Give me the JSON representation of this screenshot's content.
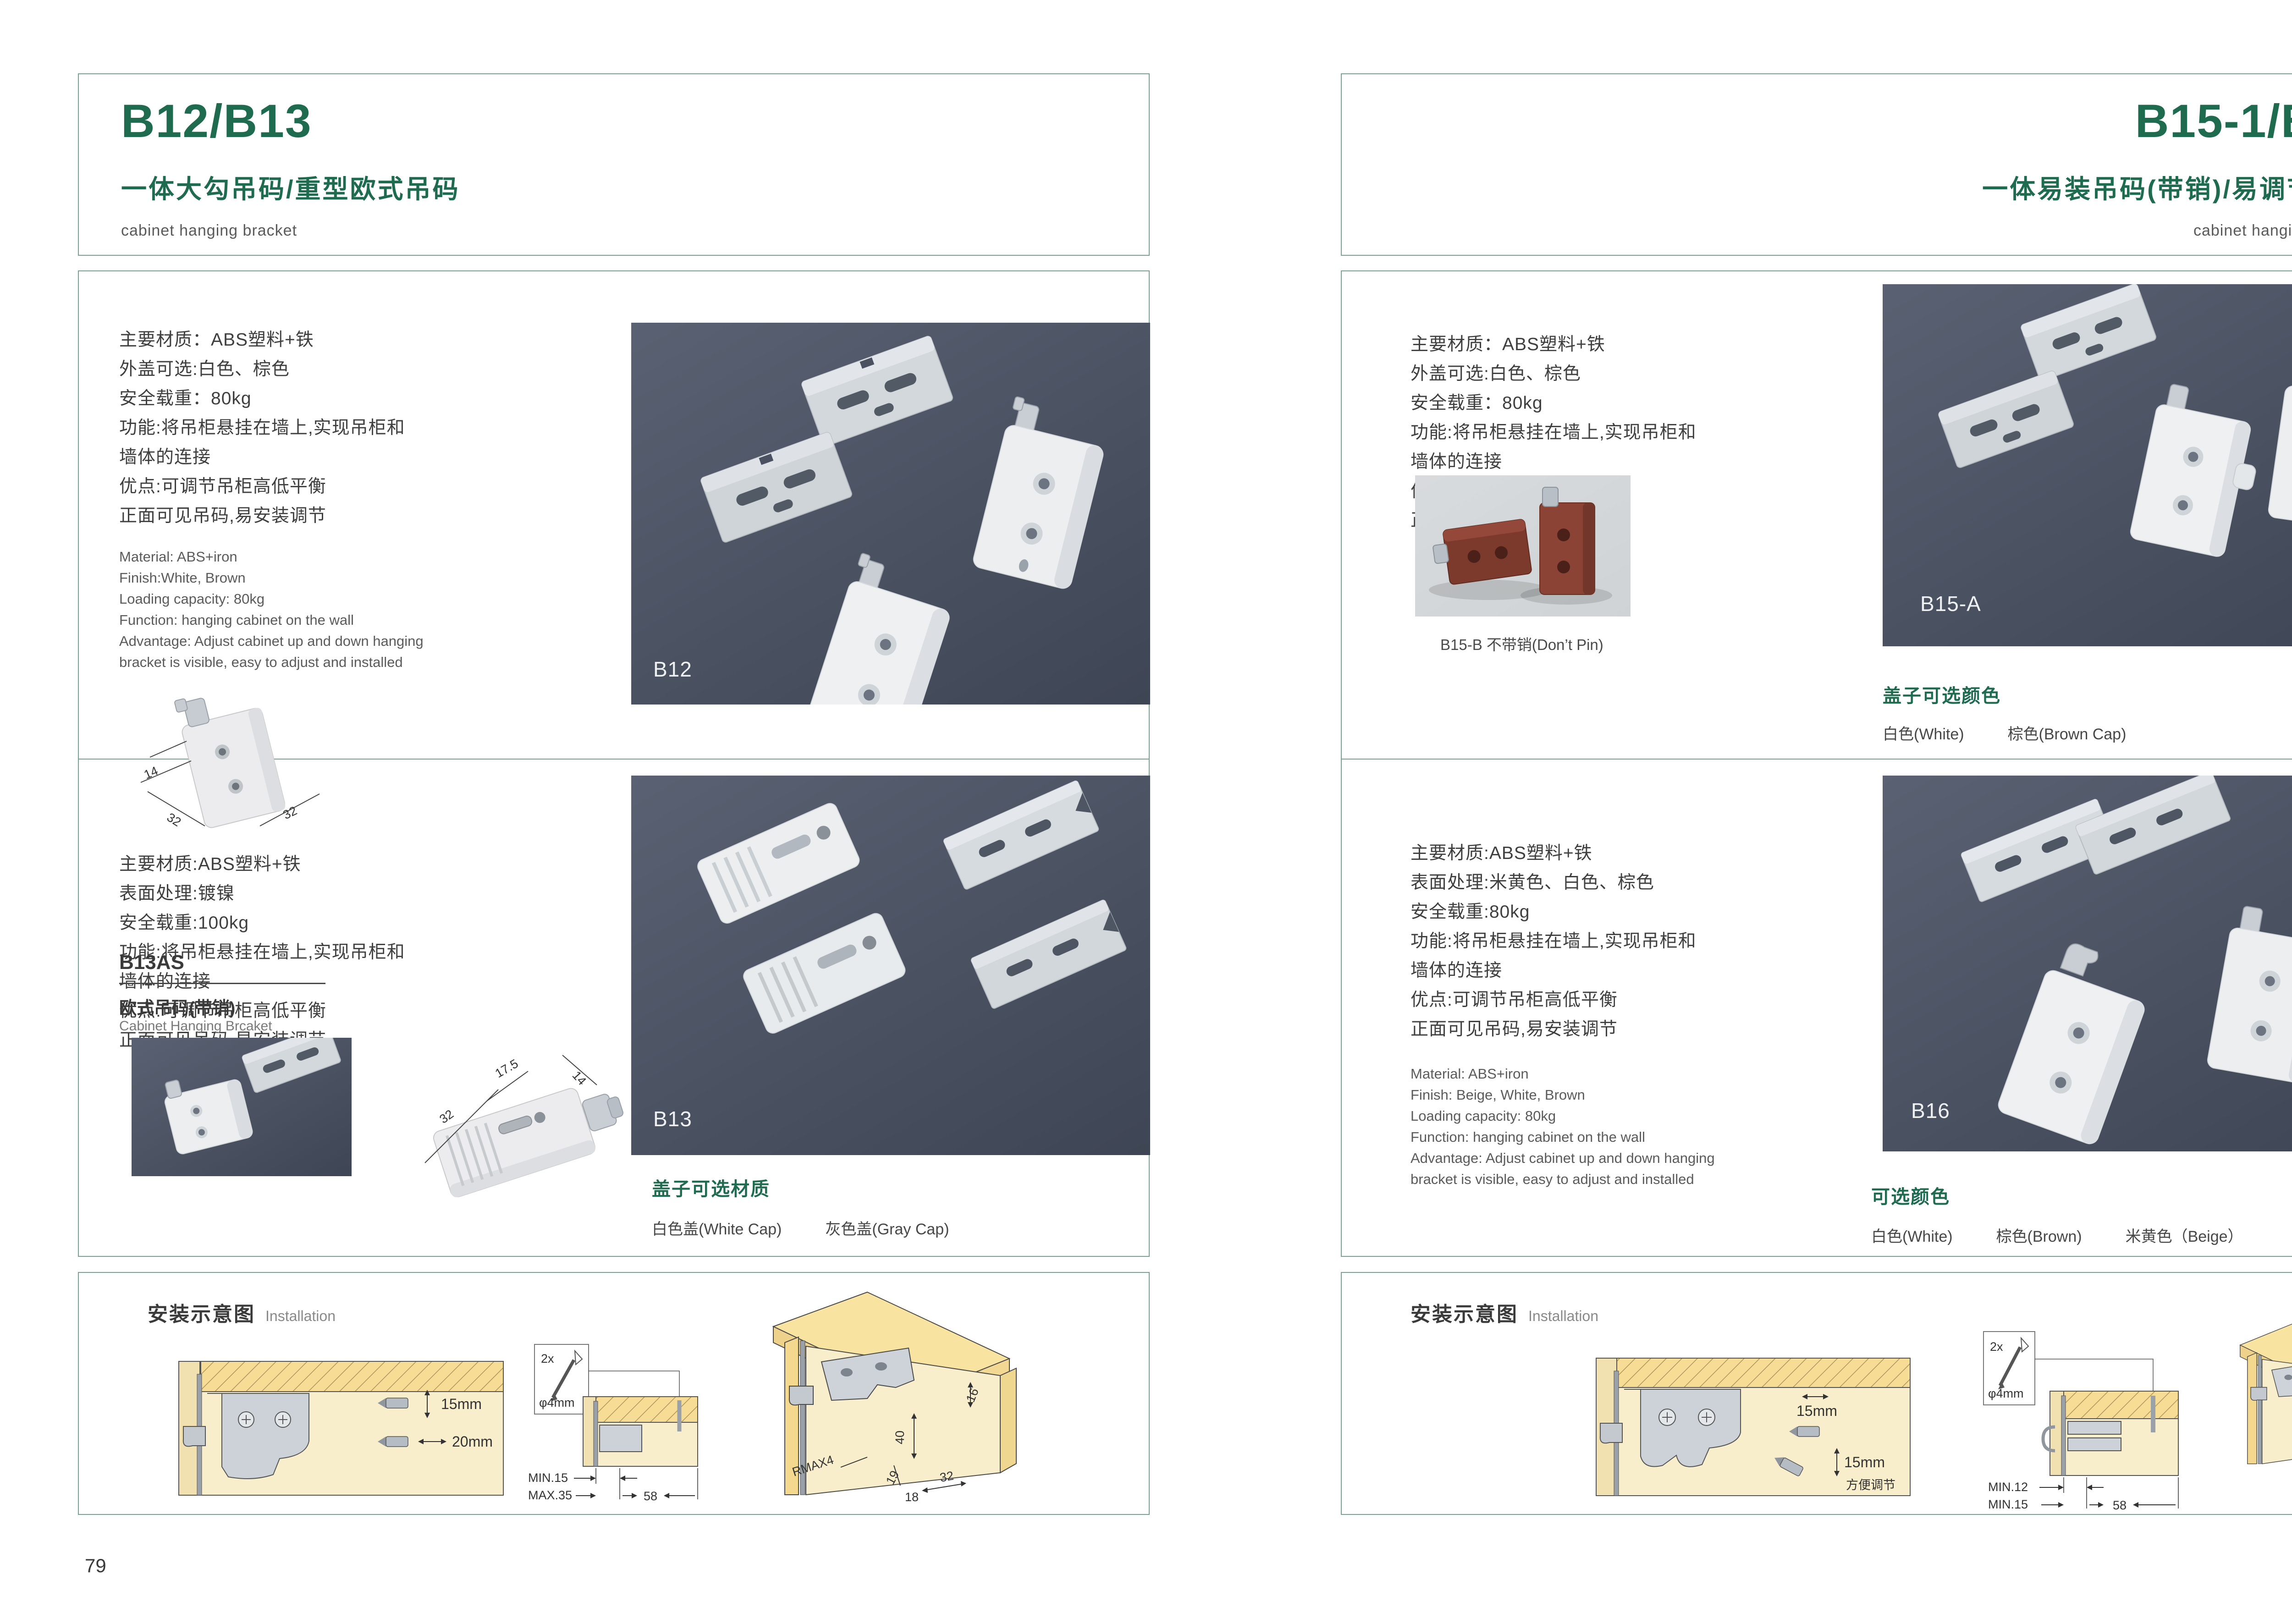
{
  "left": {
    "header": {
      "title": "B12/B13",
      "subtitle": "一体大勾吊码/重型欧式吊码",
      "category": "cabinet hanging bracket"
    },
    "b12": {
      "cn": [
        "主要材质：ABS塑料+铁",
        "外盖可选:白色、棕色",
        "安全载重：80kg",
        "功能:将吊柜悬挂在墙上,实现吊柜和",
        "墙体的连接",
        "优点:可调节吊柜高低平衡",
        "正面可见吊码,易安装调节"
      ],
      "en": [
        "Material: ABS+iron",
        "Finish:White, Brown",
        "Loading capacity: 80kg",
        "Function: hanging cabinet on the wall",
        "Advantage: Adjust cabinet up and down hanging",
        "bracket is visible, easy to adjust and installed"
      ],
      "photo_label": "B12",
      "sketch": {
        "d1": "14",
        "d2": "32",
        "d3": "32"
      }
    },
    "b13": {
      "cn": [
        "主要材质:ABS塑料+铁",
        "表面处理:镀镍",
        "安全载重:100kg",
        "功能:将吊柜悬挂在墙上,实现吊柜和",
        "墙体的连接",
        "优点:可调节吊柜高低平衡",
        "正面可见吊码,易安装调节"
      ],
      "model": "B13AS",
      "model_cn": "欧式吊码(带销)",
      "model_en": "Cabinet Hanging Brcaket",
      "photo_label": "B13",
      "sketch": {
        "d1": "32",
        "d2": "17.5",
        "d3": "14"
      },
      "caps_title": "盖子可选材质",
      "caps": [
        "白色盖(White Cap)",
        "灰色盖(Gray Cap)"
      ]
    },
    "install": {
      "title": "安装示意图",
      "title_en": "Installation",
      "d1": {
        "dim1": "15mm",
        "dim2": "20mm"
      },
      "screw": {
        "count": "2x",
        "dia": "φ4mm"
      },
      "d2": {
        "l1": "MIN.15",
        "l2": "MAX.35",
        "l3": "58"
      },
      "d3": {
        "a": "16",
        "b": "40",
        "c": "RMAX4",
        "d": "19",
        "e": "18",
        "f": "32"
      }
    },
    "page_number": "79"
  },
  "right": {
    "header": {
      "title": "B15-1/B16",
      "subtitle": "一体易装吊码(带销)/易调节吊码",
      "category": "cabinet hanging bracket"
    },
    "b15": {
      "cn": [
        "主要材质：ABS塑料+铁",
        "外盖可选:白色、棕色",
        "安全载重：80kg",
        "功能:将吊柜悬挂在墙上,实现吊柜和",
        "墙体的连接",
        "优点:可调节吊柜高低平衡",
        "正面可见吊码,易安装调节"
      ],
      "small_photo_caption": "B15-B 不带销(Don’t Pin)",
      "photo_label": "B15-A",
      "caps_title": "盖子可选颜色",
      "caps": [
        "白色(White)",
        "棕色(Brown Cap)"
      ]
    },
    "b16": {
      "cn": [
        "主要材质:ABS塑料+铁",
        "表面处理:米黄色、白色、棕色",
        "安全载重:80kg",
        "功能:将吊柜悬挂在墙上,实现吊柜和",
        "墙体的连接",
        "优点:可调节吊柜高低平衡",
        "正面可见吊码,易安装调节"
      ],
      "en": [
        "Material: ABS+iron",
        "Finish: Beige, White, Brown",
        "Loading capacity: 80kg",
        "Function: hanging cabinet on the wall",
        "Advantage: Adjust cabinet up and down hanging",
        "bracket is visible, easy to adjust and installed"
      ],
      "photo_label": "B16",
      "colors_title": "可选颜色",
      "colors": [
        "白色(White)",
        "棕色(Brown)",
        "米黄色（Beige）"
      ]
    },
    "install": {
      "title": "安装示意图",
      "title_en": "Installation",
      "d1": {
        "dim1": "15mm",
        "dim2": "15mm",
        "note": "方便调节"
      },
      "screw": {
        "count": "2x",
        "dia": "φ4mm"
      },
      "d2": {
        "l1": "MIN.12",
        "l2": "MIN.15",
        "l3": "58"
      },
      "d3": {
        "a": "19",
        "b": "32"
      }
    },
    "page_number": "80"
  }
}
